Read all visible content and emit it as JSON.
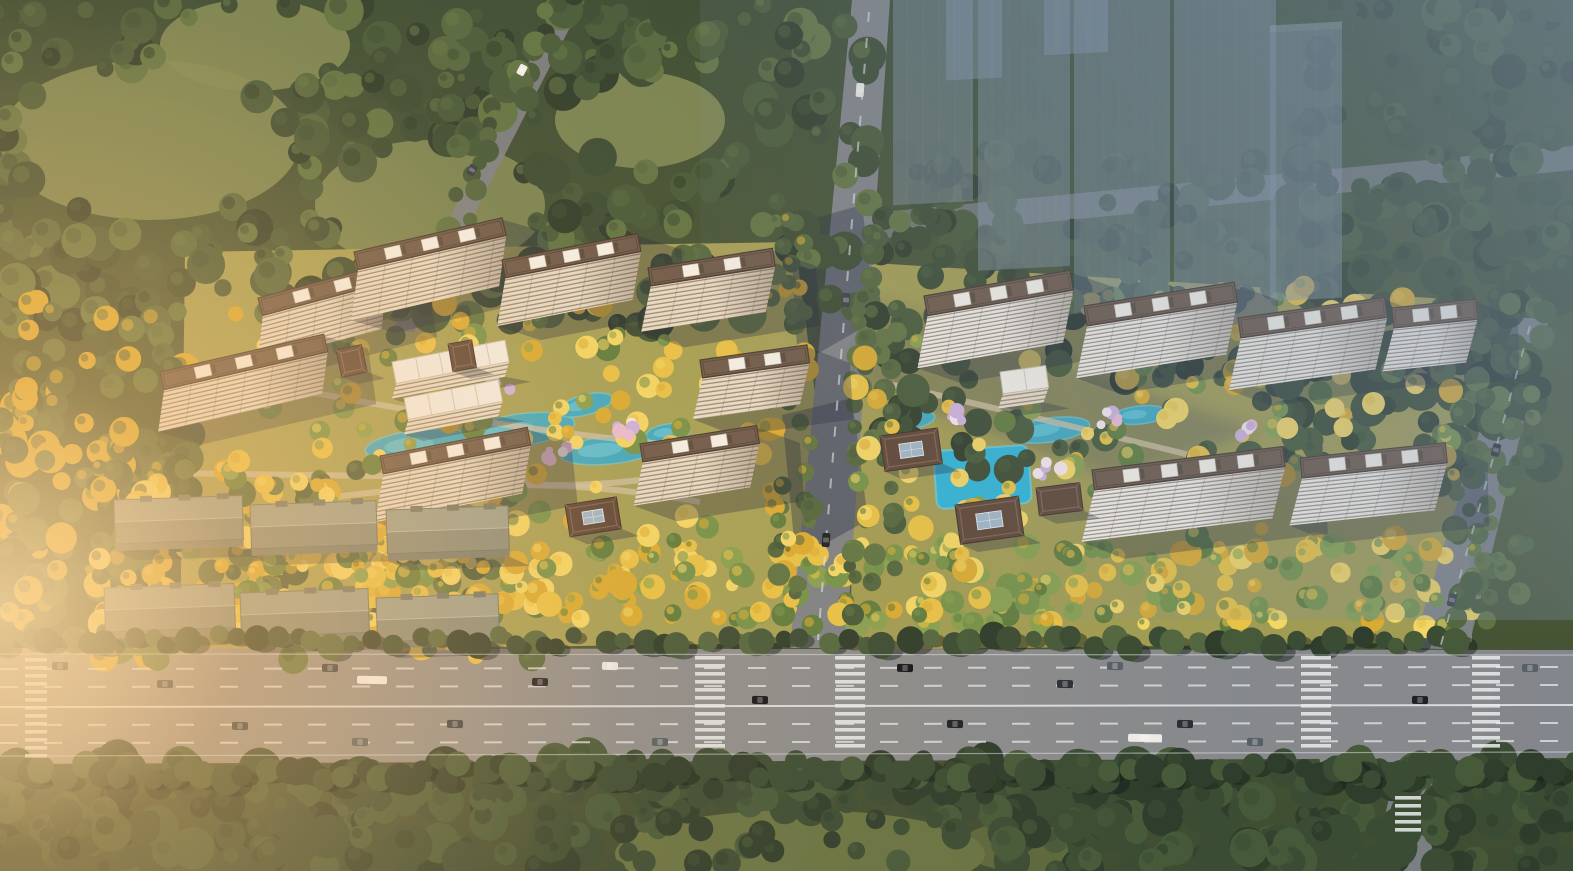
{
  "scene": {
    "type": "aerial-architectural-rendering",
    "subject": "bird's-eye rendering of a two-parcel residential development with mid-rise towers, landscaped courtyards with turquoise ponds and a pool, golden autumn trees, a wide multi-lane boulevard with traffic in front, dense forest around, and translucent ghosted future towers at the upper right",
    "lighting": "warm low sun from the left, cool blue haze toward the upper right"
  },
  "counts": {
    "west_towers": 8,
    "east_towers": 6,
    "warehouse_slabs": 6,
    "ghost_towers": 7
  },
  "palette": {
    "base1": "#4c5a38",
    "base2": "#3e4c31",
    "meadow": "#7e8a55",
    "meadow2": "#969c5f",
    "forest1": "#2e3d2c",
    "forest2": "#3a4c34",
    "forest3": "#465a3a",
    "forest4": "#536740",
    "forest5": "#5f7444",
    "treeGreen1": "#5f7c3e",
    "treeGreen2": "#74924a",
    "treeGreen3": "#86a050",
    "gold1": "#d8ab33",
    "gold2": "#e7c247",
    "gold3": "#f2d666",
    "blossom1": "#e9bcd4",
    "blossom2": "#f6e8ef",
    "lilac": "#cdb2de",
    "pond": "#3fa9c0",
    "pondLight": "#6fd0e0",
    "pool": "#2fb4d8",
    "lawnWest": "#aaa458",
    "lawnEast": "#a5a055",
    "path": "#cfc2a4",
    "roadMain1": "#9b948a",
    "roadMain2": "#83868c",
    "roadMinor": "#7e8288",
    "laneWhite": "#e6e9e9",
    "westFacade": "#e6dcc9",
    "westStripe": "#8d7c68",
    "eastFacade": "#f2efe8",
    "eastStripe": "#837668",
    "roofDark": "#463931",
    "roofMid": "#6d5a4b",
    "roofEdge": "#8d7765",
    "rooftopBox": "#f4f1e8",
    "clubRoof": "#f1eee6",
    "shedRoof": "#9aa08f",
    "shedDark": "#70766a",
    "pavRoof": "#5d4639",
    "pavRidge": "#7d6451",
    "skylight": "#9fb6c8",
    "ghost": "#8496ab",
    "ghostTop": "#a8b6c6",
    "haze": "#7c8fa8",
    "glow": "#ffc67a",
    "glowCore": "#ffe0ac",
    "shadow": "rgba(28,38,58,0.32)",
    "roadShadow": "rgba(30,42,66,0.38)"
  },
  "vehicles": {
    "car_colors": [
      "#1d2126",
      "#2a2f36",
      "#3a4046",
      "#566066",
      "#14171b",
      "#e8e8e6"
    ],
    "bus_color": "#eceae6",
    "truck_color": "#f2f2f0"
  }
}
